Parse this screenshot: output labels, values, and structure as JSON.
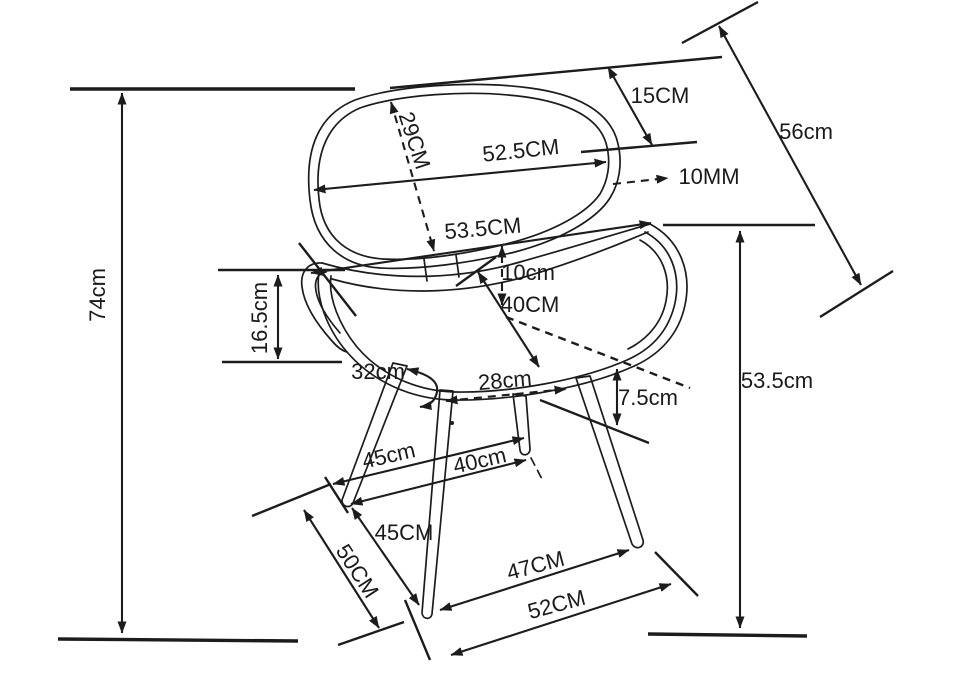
{
  "diagram": {
    "subject": "chair-dimension-drawing",
    "background": "#ffffff",
    "ink_color": "#1c1c1c",
    "labels": {
      "overall_height": "74cm",
      "seat_side_height": "16.5cm",
      "backrest_height": "29CM",
      "backrest_width": "52.5CM",
      "backrest_top_offset": "15CM",
      "back_diagonal_length": "56cm",
      "backrest_thickness": "10MM",
      "seat_width": "53.5CM",
      "backrest_seat_gap": "10cm",
      "seat_depth": "40CM",
      "seat_left_edge": "32cm",
      "under_seat_span": "28cm",
      "seat_front_drop": "7.5cm",
      "seat_height_to_floor": "53.5cm",
      "leg_span_upper": "45cm",
      "leg_span_inner": "40cm",
      "front_leg_length": "45CM",
      "rear_leg_length": "50CM",
      "front_feet_span": "47CM",
      "base_span": "52CM"
    }
  }
}
